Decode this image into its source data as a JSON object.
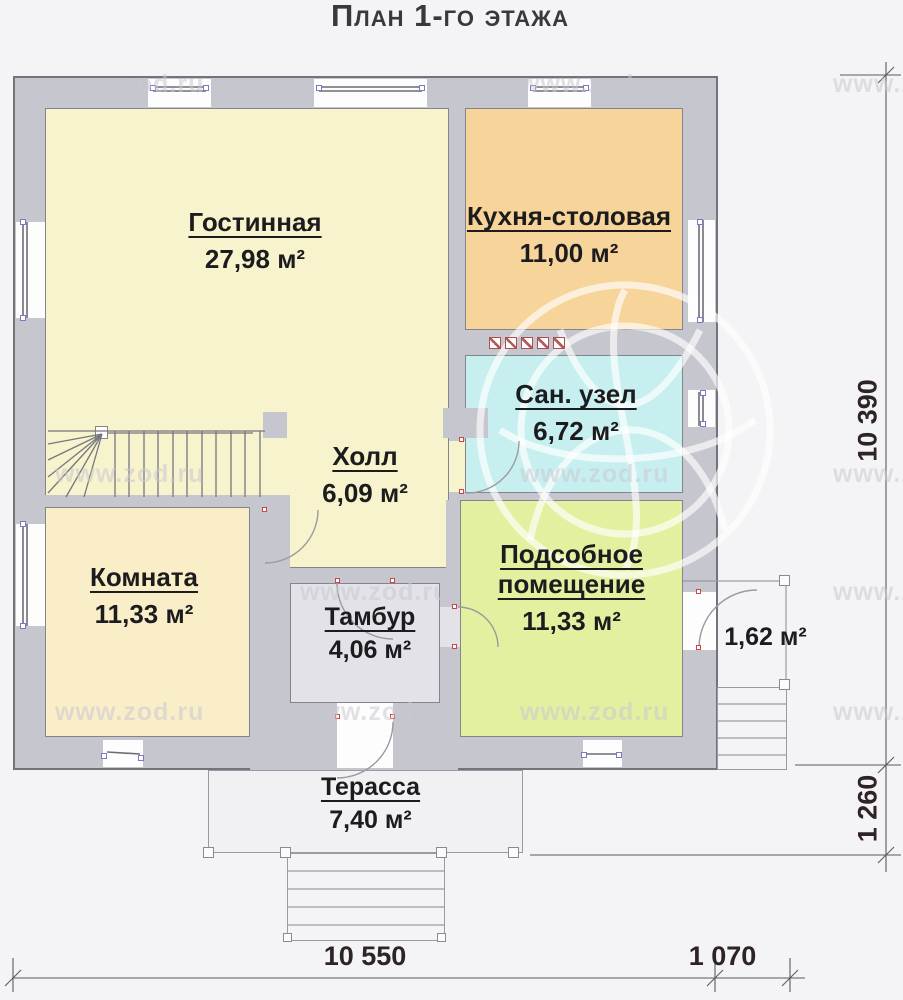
{
  "title": "План 1-го этажа",
  "watermark": {
    "text": "www.zod.ru"
  },
  "rooms": [
    {
      "id": "living",
      "name": "Гостинная",
      "area": "27,98 м²",
      "color": "#f7f3cd"
    },
    {
      "id": "kitchen",
      "name": "Кухня-столовая",
      "area": "11,00 м²",
      "color": "#f7d49a"
    },
    {
      "id": "bathroom",
      "name": "Сан. узел",
      "area": "6,72 м²",
      "color": "#c8eff0"
    },
    {
      "id": "hall",
      "name": "Холл",
      "area": "6,09 м²",
      "color": "#f7f3cd"
    },
    {
      "id": "bedroom",
      "name": "Комната",
      "area": "11,33 м²",
      "color": "#faeec9"
    },
    {
      "id": "utility",
      "name": "Подсобное помещение",
      "area": "11,33 м²",
      "color": "#e3f0a0"
    },
    {
      "id": "vestibule",
      "name": "Тамбур",
      "area": "4,06 м²",
      "color": "#e2e2e8"
    },
    {
      "id": "terrace",
      "name": "Терасса",
      "area": "7,40 м²",
      "color": "#f1f1f4"
    },
    {
      "id": "porch",
      "name": "",
      "area": "1,62 м²",
      "color": "#f4f4f6"
    }
  ],
  "dimensions": {
    "right_total": "10 390",
    "right_lower": "1 260",
    "bottom_total": "10 550",
    "bottom_right": "1 070"
  },
  "colors": {
    "wall": "#c6c6ce",
    "background": "#f4f4f6",
    "window_marker": "#7a7ac2",
    "hinge_marker": "#cc4444",
    "dimension_text": "#2e2326"
  }
}
